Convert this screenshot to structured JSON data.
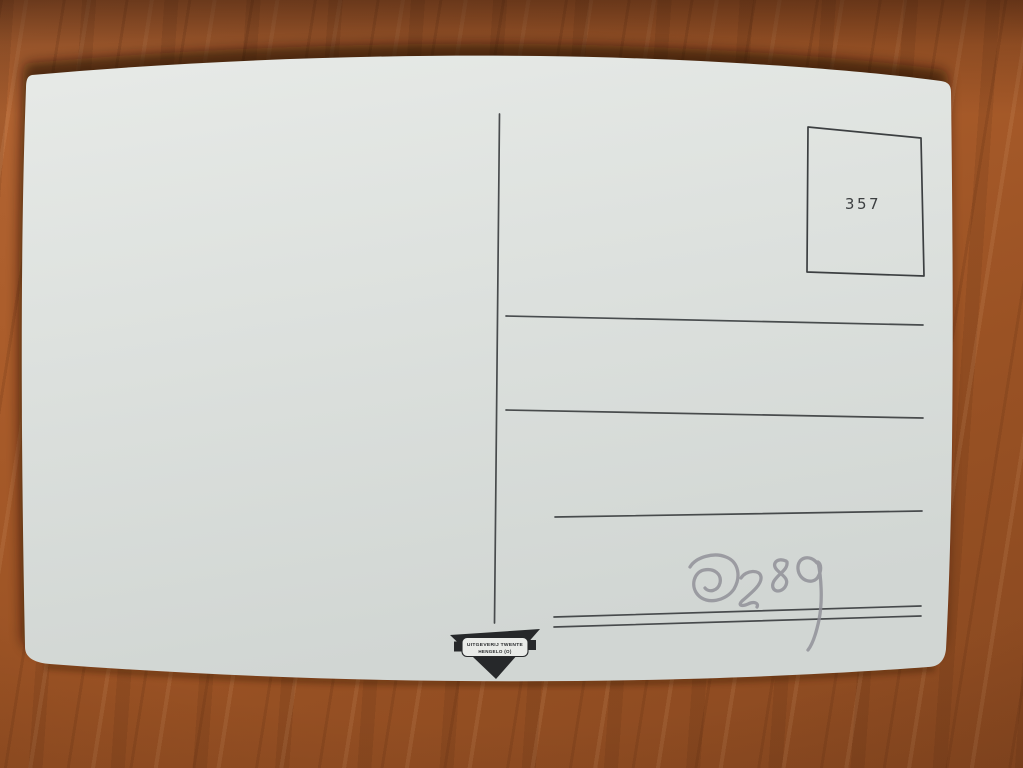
{
  "postcard": {
    "stamp_box": {
      "number": "357"
    },
    "publisher_mark": {
      "line1": "UITGEVERIJ TWENTE",
      "line2": "HENGELO (O)"
    },
    "handwritten_number": "0289",
    "address_lines": {
      "single_lines": 3,
      "double_lines": 1
    },
    "colors": {
      "wood": "#a4582a",
      "card": "#dde1de",
      "printed_ink": "#3c3f41",
      "logo_ink": "#26282a",
      "pencil": "#8f8f97"
    }
  }
}
